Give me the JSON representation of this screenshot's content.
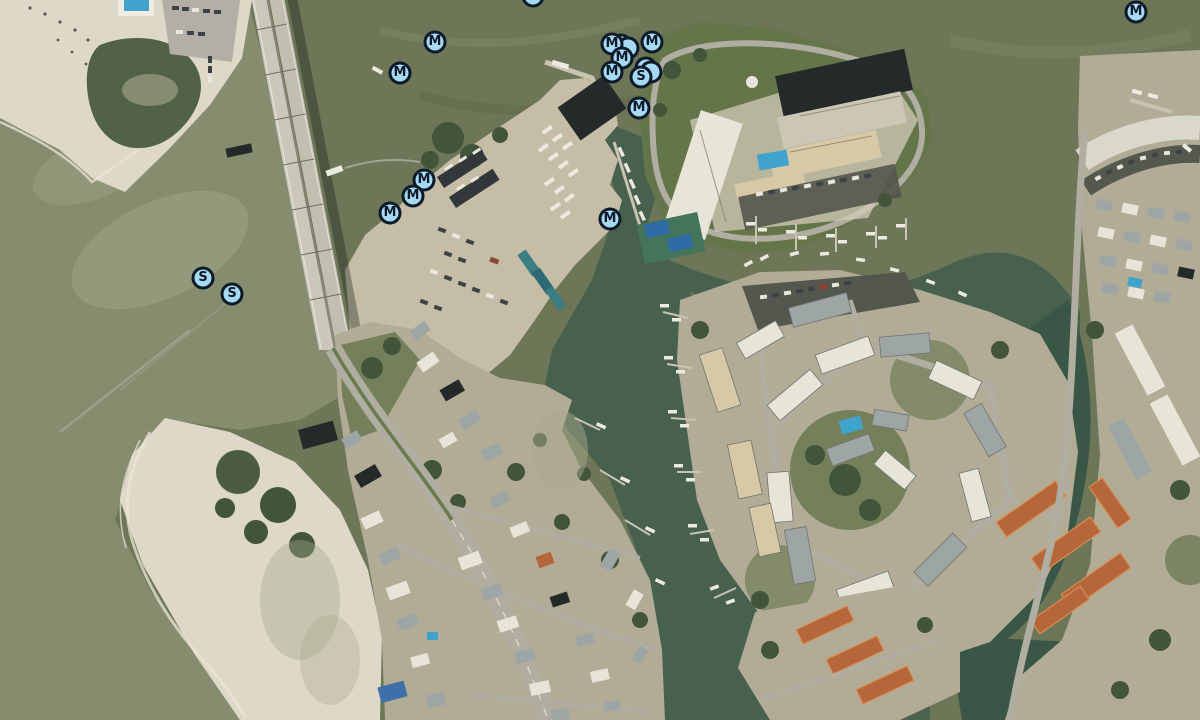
{
  "map": {
    "view_type": "satellite",
    "width": 1200,
    "height": 720
  },
  "marker_style": {
    "diameter": 23,
    "border_width": 3.5,
    "font_size": 13,
    "fill": "#a6d9f2",
    "stroke": "#0c1a29"
  },
  "markers": [
    {
      "label": "",
      "x": 621,
      "y": 45,
      "kind": "stacked-marker"
    },
    {
      "label": "",
      "x": 628,
      "y": 48,
      "kind": "stacked-marker"
    },
    {
      "label": "M",
      "x": 652,
      "y": 42,
      "kind": "mooring-marker"
    },
    {
      "label": "M",
      "x": 612,
      "y": 44,
      "kind": "mooring-marker"
    },
    {
      "label": "M",
      "x": 622,
      "y": 58,
      "kind": "mooring-marker"
    },
    {
      "label": "",
      "x": 646,
      "y": 68,
      "kind": "stacked-marker"
    },
    {
      "label": "",
      "x": 651,
      "y": 72,
      "kind": "stacked-marker"
    },
    {
      "label": "M",
      "x": 612,
      "y": 72,
      "kind": "mooring-marker"
    },
    {
      "label": "S",
      "x": 641,
      "y": 77,
      "kind": "s-marker"
    },
    {
      "label": "M",
      "x": 639,
      "y": 108,
      "kind": "mooring-marker"
    },
    {
      "label": "M",
      "x": 533,
      "y": -4,
      "kind": "mooring-marker"
    },
    {
      "label": "M",
      "x": 435,
      "y": 42,
      "kind": "mooring-marker"
    },
    {
      "label": "M",
      "x": 400,
      "y": 73,
      "kind": "mooring-marker"
    },
    {
      "label": "M",
      "x": 424,
      "y": 180,
      "kind": "mooring-marker"
    },
    {
      "label": "M",
      "x": 413,
      "y": 196,
      "kind": "mooring-marker"
    },
    {
      "label": "M",
      "x": 390,
      "y": 213,
      "kind": "mooring-marker"
    },
    {
      "label": "M",
      "x": 610,
      "y": 219,
      "kind": "mooring-marker"
    },
    {
      "label": "S",
      "x": 203,
      "y": 278,
      "kind": "s-marker"
    },
    {
      "label": "S",
      "x": 232,
      "y": 294,
      "kind": "s-marker"
    },
    {
      "label": "M",
      "x": 1136,
      "y": 12,
      "kind": "mooring-marker"
    }
  ],
  "palette": {
    "water_base": "#6d7656",
    "water_gulf": "#868d6e",
    "water_channel": "#47614e",
    "water_deep": "#3a5646",
    "sand": "#ddd8c8",
    "sand_shallow": "#a8a88b",
    "land": "#b2ac97",
    "gravel": "#c6bda7",
    "road": "#b0ada1",
    "lot": "#54574e",
    "roof_gray": "#9ea5a5",
    "roof_white": "#e7e4d8",
    "roof_dark": "#242a2a",
    "roof_beige": "#d8c9a6",
    "roof_orange": "#b4673a",
    "roof_blue": "#3e6fa8",
    "lawn": "#64754a",
    "tree": "#42553a",
    "pool": "#3fa3cc",
    "court": "#2d6ca5",
    "bridge": "#cbc8bb",
    "boat": "#eceade",
    "pier": "#c9c3b2",
    "marker_fill": "#a6d9f2",
    "marker_stroke": "#0c1a29"
  }
}
